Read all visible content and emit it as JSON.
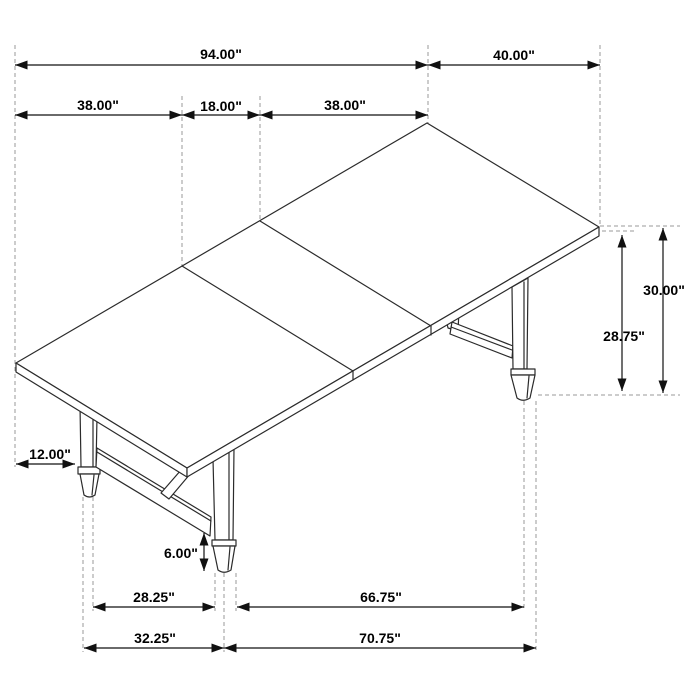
{
  "drawing": {
    "kind": "isometric dimension drawing",
    "subject": "trestle dining table with extension leaf",
    "background": "#ffffff"
  },
  "colors": {
    "outline": "#2b2b2b",
    "dimension_line": "#111111",
    "extension_line": "#999999",
    "text": "#000000"
  },
  "dimensions": {
    "overall_length": "94.00\"",
    "end_width": "40.00\"",
    "left_section": "38.00\"",
    "leaf_section": "18.00\"",
    "right_section": "38.00\"",
    "overall_height": "30.00\"",
    "underside_height": "28.75\"",
    "end_overhang": "12.00\"",
    "foot_height": "6.00\"",
    "foot_gap_inner_left": "28.25\"",
    "foot_gap_inner_right": "66.75\"",
    "foot_span_left": "32.25\"",
    "foot_span_right": "70.75\""
  }
}
